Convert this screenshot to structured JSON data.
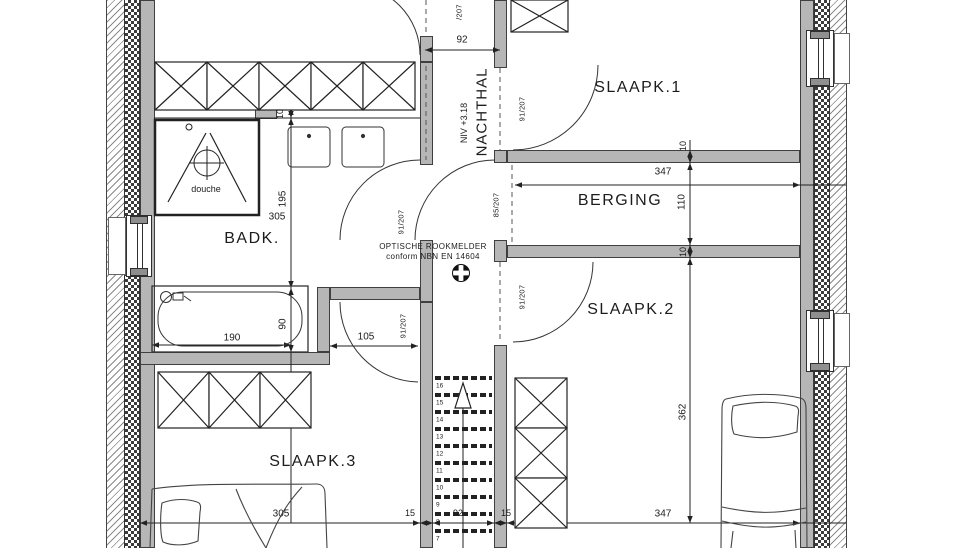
{
  "colors": {
    "wall_fill": "#b6b6b6",
    "line": "#222222",
    "background": "#ffffff"
  },
  "rooms": {
    "slaapk1": "SLAAPK.1",
    "berging": "BERGING",
    "slaapk2": "SLAAPK.2",
    "slaapk3": "SLAAPK.3",
    "badk": "BADK.",
    "douche": "douche",
    "nachthal": "NACHTHAL",
    "nachthal_level": "NIV +3.18"
  },
  "doors": {
    "slaapk1": "91/207",
    "slaapk2": "91/207",
    "badk": "91/207",
    "slaapk3": "91/207",
    "berging": "85/207",
    "top_partial": "/207"
  },
  "notes": {
    "smoke_line1": "OPTISCHE ROOKMELDER",
    "smoke_line2": "conform NBN EN 14604"
  },
  "dims": {
    "corridor_top_width": "92",
    "berging_width": "347",
    "berging_depth": "110",
    "wall_top": "10",
    "wall_mid": "10",
    "vanity": "10",
    "badk_a": "195",
    "badk_b": "305",
    "bath_length": "190",
    "bath_width": "90",
    "badk_door": "105",
    "slaapk3_width": "305",
    "stair_margin_left": "15",
    "stair_width": "92",
    "stair_margin_right": "15",
    "slaapk2_width": "347",
    "slaapk2_depth": "362"
  },
  "stairs": {
    "steps": [
      "16",
      "15",
      "14",
      "13",
      "12",
      "11",
      "10",
      "9",
      "8",
      "7"
    ]
  }
}
